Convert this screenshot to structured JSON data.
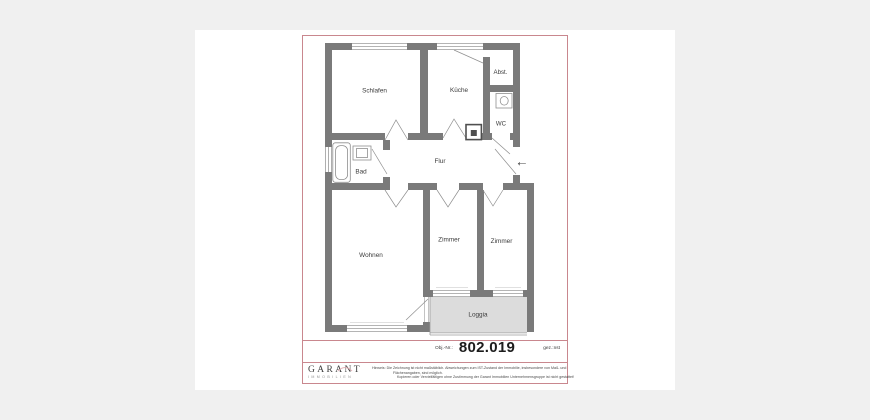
{
  "plan": {
    "rooms": {
      "schlafen": "Schlafen",
      "kueche": "Küche",
      "abstellraum": "Abst.",
      "wc": "WC",
      "flur": "Flur",
      "bad": "Bad",
      "wohnen": "Wohnen",
      "zimmer_1": "Zimmer",
      "zimmer_2": "Zimmer",
      "loggia": "Loggia"
    }
  },
  "icons": {
    "entrance_arrow": "←"
  },
  "object_info": {
    "label": "Obj.-Nr.:",
    "number": "802.019",
    "drawn_by": "gez.:nst"
  },
  "branding": {
    "name": "GARANT",
    "subtitle": "IMMOBILIEN"
  },
  "disclaimer": {
    "line1": "Hinweis: Die Zeichnung ist nicht maßstäblich. Abweichungen zum IST-Zustand der Immobilie, insbesondere von Maß- und",
    "line2": "Flächenangaben, sind möglich.",
    "line3": "Kopieren oder Vervielfältigen ohne Zustimmung der Garant Immobilien Unternehmensgruppe ist nicht gestattet!"
  },
  "colors": {
    "frame_red": "#c9878e",
    "wall_gray": "#7a7a7a",
    "loggia_fill": "#dcdcdc",
    "canvas_bg": "#f0f0f0"
  }
}
